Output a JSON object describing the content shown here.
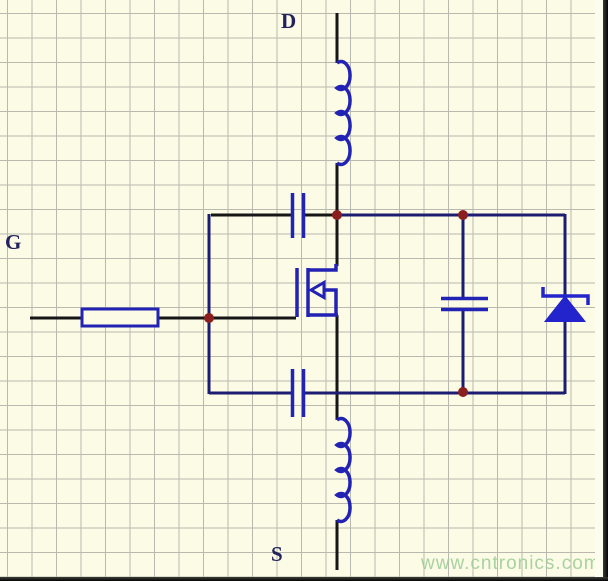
{
  "labels": {
    "drain": "D",
    "gate": "G",
    "source": "S"
  },
  "watermark": "www.cntronics.com",
  "colors": {
    "bg": "#fbfbe6",
    "grid": "#b9b9af",
    "wire_black": "#161616",
    "wire_navy": "#1c1c72",
    "component_blue": "#2222b4",
    "diode_blue": "#2424cc",
    "junction_red": "#8b1e1e",
    "label": "#22225e",
    "wm": "#9ccb96"
  },
  "components": [
    {
      "name": "drain-inductor",
      "type": "inductor"
    },
    {
      "name": "gate-resistor",
      "type": "resistor"
    },
    {
      "name": "gate-drain-capacitor",
      "type": "capacitor"
    },
    {
      "name": "mosfet",
      "type": "n-channel-mosfet"
    },
    {
      "name": "drain-source-capacitor",
      "type": "capacitor"
    },
    {
      "name": "body-diode",
      "type": "zener-diode"
    },
    {
      "name": "gate-source-capacitor",
      "type": "capacitor"
    },
    {
      "name": "source-inductor",
      "type": "inductor"
    }
  ]
}
